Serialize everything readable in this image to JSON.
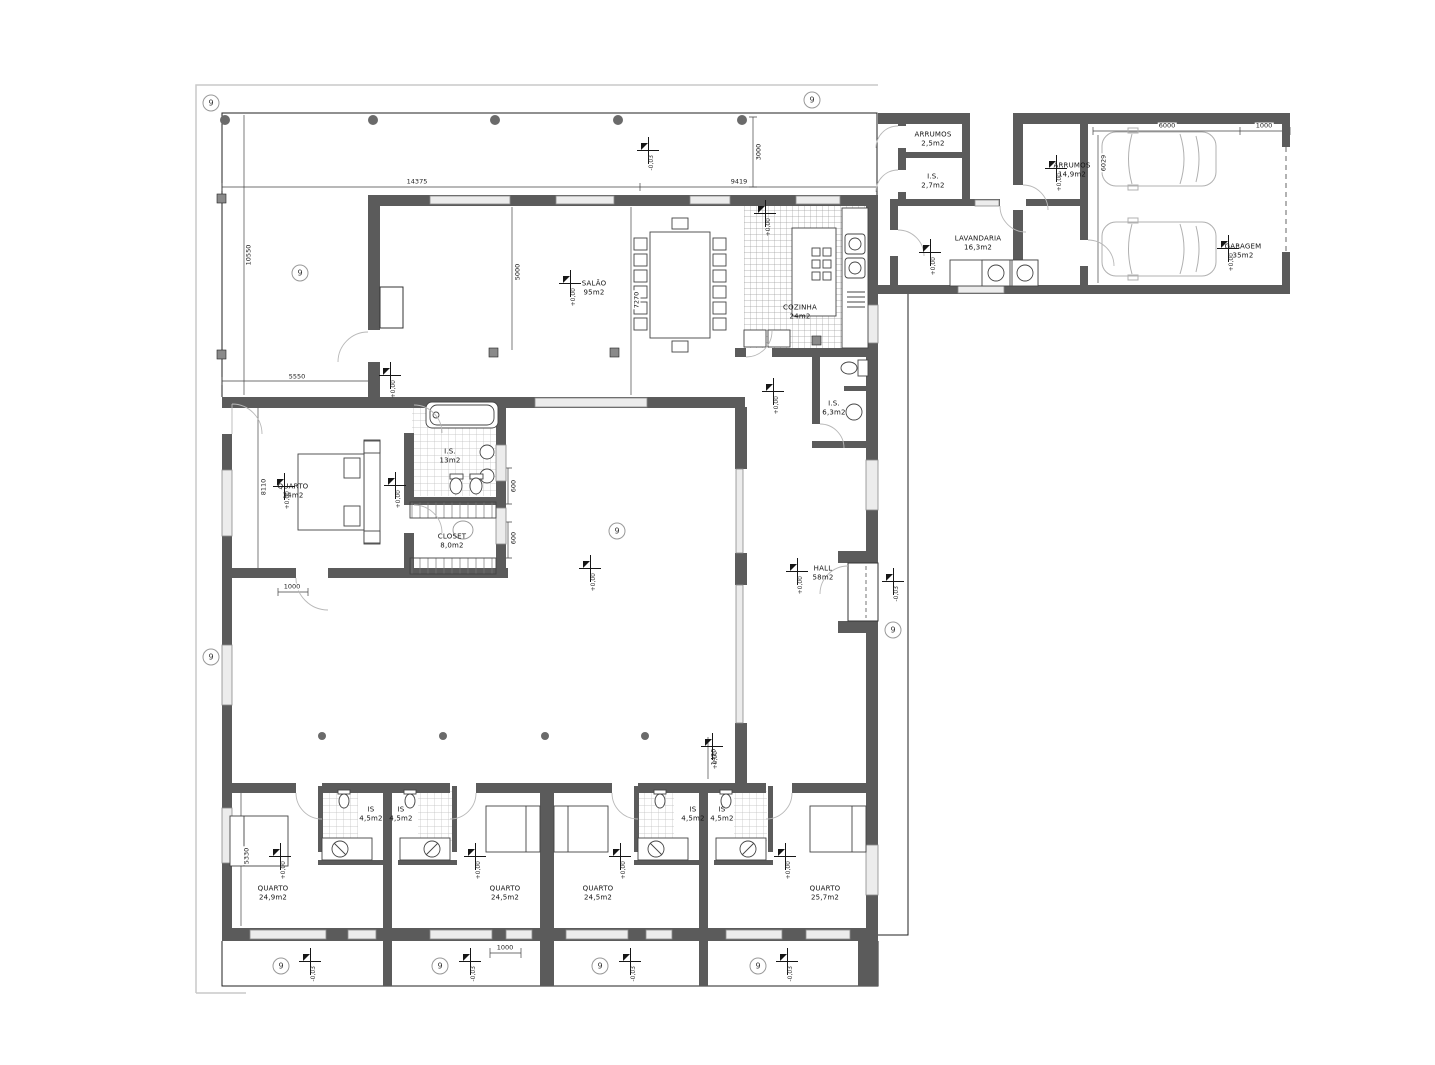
{
  "grid": {
    "label": "9",
    "bubbles": [
      {
        "x": 211,
        "y": 103
      },
      {
        "x": 812,
        "y": 100
      },
      {
        "x": 300,
        "y": 273
      },
      {
        "x": 211,
        "y": 657
      },
      {
        "x": 893,
        "y": 630
      },
      {
        "x": 617,
        "y": 531
      },
      {
        "x": 281,
        "y": 966
      },
      {
        "x": 440,
        "y": 966
      },
      {
        "x": 600,
        "y": 966
      },
      {
        "x": 758,
        "y": 966
      }
    ]
  },
  "levels": {
    "interior": "+0,00",
    "exterior": "-0,03",
    "markers": [
      {
        "x": 765,
        "y": 213,
        "v": "interior"
      },
      {
        "x": 930,
        "y": 252,
        "v": "interior"
      },
      {
        "x": 1056,
        "y": 168,
        "v": "interior"
      },
      {
        "x": 1228,
        "y": 248,
        "v": "interior"
      },
      {
        "x": 570,
        "y": 283,
        "v": "interior"
      },
      {
        "x": 390,
        "y": 375,
        "v": "interior"
      },
      {
        "x": 284,
        "y": 486,
        "v": "interior"
      },
      {
        "x": 395,
        "y": 485,
        "v": "interior"
      },
      {
        "x": 590,
        "y": 568,
        "v": "interior"
      },
      {
        "x": 797,
        "y": 571,
        "v": "interior"
      },
      {
        "x": 773,
        "y": 391,
        "v": "interior"
      },
      {
        "x": 280,
        "y": 856,
        "v": "interior"
      },
      {
        "x": 475,
        "y": 856,
        "v": "interior"
      },
      {
        "x": 620,
        "y": 856,
        "v": "interior"
      },
      {
        "x": 785,
        "y": 856,
        "v": "interior"
      },
      {
        "x": 712,
        "y": 746,
        "v": "interior"
      },
      {
        "x": 648,
        "y": 150,
        "v": "exterior"
      },
      {
        "x": 893,
        "y": 581,
        "v": "exterior"
      },
      {
        "x": 310,
        "y": 961,
        "v": "exterior"
      },
      {
        "x": 470,
        "y": 961,
        "v": "exterior"
      },
      {
        "x": 630,
        "y": 961,
        "v": "exterior"
      },
      {
        "x": 787,
        "y": 961,
        "v": "exterior"
      }
    ]
  },
  "rooms": [
    {
      "name": "SALÃO",
      "area": "95m2",
      "x": 594,
      "y": 288
    },
    {
      "name": "COZINHA",
      "area": "24m2",
      "x": 800,
      "y": 312
    },
    {
      "name": "LAVANDARIA",
      "area": "16,3m2",
      "x": 978,
      "y": 243
    },
    {
      "name": "ARRUMOS",
      "area": "2,5m2",
      "x": 933,
      "y": 139
    },
    {
      "name": "I.S.",
      "area": "2,7m2",
      "x": 933,
      "y": 181
    },
    {
      "name": "ARRUMOS",
      "area": "14,9m2",
      "x": 1072,
      "y": 170
    },
    {
      "name": "GARAGEM",
      "area": "35m2",
      "x": 1243,
      "y": 251
    },
    {
      "name": "I.S.",
      "area": "6,3m2",
      "x": 834,
      "y": 408
    },
    {
      "name": "HALL",
      "area": "58m2",
      "x": 823,
      "y": 573
    },
    {
      "name": "QUARTO",
      "area": "34m2",
      "x": 293,
      "y": 491
    },
    {
      "name": "I.S.",
      "area": "13m2",
      "x": 450,
      "y": 456
    },
    {
      "name": "CLOSET",
      "area": "8,0m2",
      "x": 452,
      "y": 541
    },
    {
      "name": "IS",
      "area": "4,5m2",
      "x": 371,
      "y": 814
    },
    {
      "name": "IS",
      "area": "4,5m2",
      "x": 401,
      "y": 814
    },
    {
      "name": "IS",
      "area": "4,5m2",
      "x": 693,
      "y": 814
    },
    {
      "name": "IS",
      "area": "4,5m2",
      "x": 722,
      "y": 814
    },
    {
      "name": "QUARTO",
      "area": "24,9m2",
      "x": 273,
      "y": 893
    },
    {
      "name": "QUARTO",
      "area": "24,5m2",
      "x": 505,
      "y": 893
    },
    {
      "name": "QUARTO",
      "area": "24,5m2",
      "x": 598,
      "y": 893
    },
    {
      "name": "QUARTO",
      "area": "25,7m2",
      "x": 825,
      "y": 893
    }
  ],
  "dimensions": [
    {
      "text": "14375",
      "x": 417,
      "y": 182,
      "rot": 0
    },
    {
      "text": "9419",
      "x": 739,
      "y": 182,
      "rot": 0
    },
    {
      "text": "3000",
      "x": 759,
      "y": 152,
      "rot": 90
    },
    {
      "text": "10550",
      "x": 249,
      "y": 255,
      "rot": 90
    },
    {
      "text": "5550",
      "x": 297,
      "y": 377,
      "rot": 0
    },
    {
      "text": "8110",
      "x": 264,
      "y": 487,
      "rot": 90
    },
    {
      "text": "1000",
      "x": 292,
      "y": 587,
      "rot": 0
    },
    {
      "text": "600",
      "x": 514,
      "y": 486,
      "rot": 90
    },
    {
      "text": "600",
      "x": 514,
      "y": 538,
      "rot": 90
    },
    {
      "text": "5000",
      "x": 518,
      "y": 272,
      "rot": 90
    },
    {
      "text": "7270",
      "x": 637,
      "y": 300,
      "rot": 90
    },
    {
      "text": "6000",
      "x": 1167,
      "y": 126,
      "rot": 0
    },
    {
      "text": "1000",
      "x": 1264,
      "y": 126,
      "rot": 0
    },
    {
      "text": "6029",
      "x": 1104,
      "y": 163,
      "rot": 90
    },
    {
      "text": "5330",
      "x": 247,
      "y": 856,
      "rot": 90
    },
    {
      "text": "1000",
      "x": 505,
      "y": 948,
      "rot": 0
    },
    {
      "text": "1420",
      "x": 714,
      "y": 757,
      "rot": 90
    }
  ],
  "colors": {
    "wall": "#5b5b5b",
    "line": "#1a1a1a",
    "window_fill": "#ececec",
    "window_edge": "#8a8a8a",
    "tile_line": "#b5b5b5",
    "kitchen_tile_line": "#a0a0a0",
    "frame": "#c9c9c9",
    "column": "#6a6a6a"
  }
}
